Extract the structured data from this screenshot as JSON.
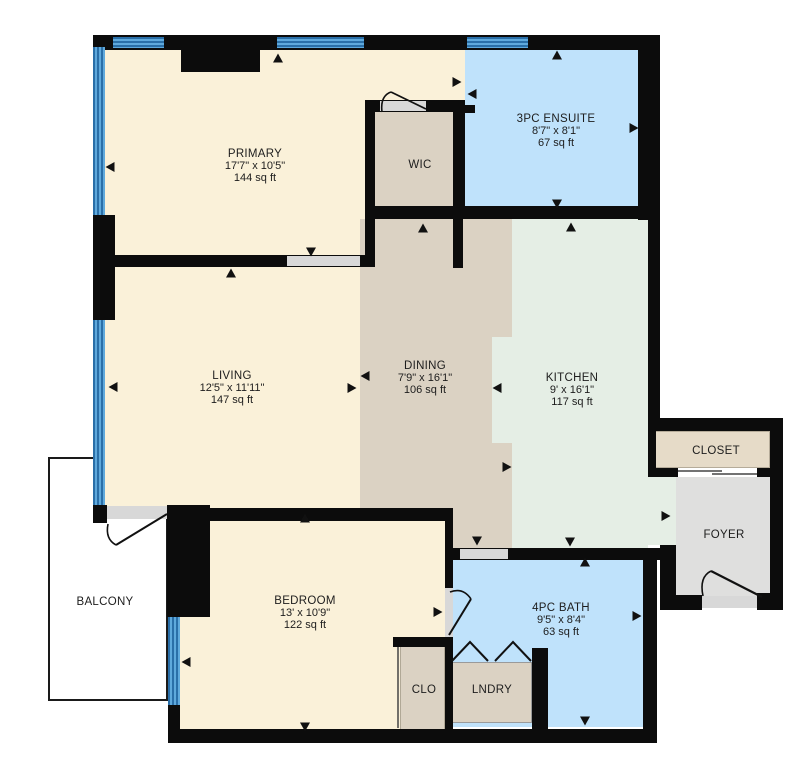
{
  "rooms": {
    "primary": {
      "name": "PRIMARY",
      "dims": "17'7\" x 10'5\"",
      "area": "144 sq ft"
    },
    "wic": {
      "name": "WIC"
    },
    "ensuite": {
      "name": "3PC ENSUITE",
      "dims": "8'7\" x 8'1\"",
      "area": "67 sq ft"
    },
    "living": {
      "name": "LIVING",
      "dims": "12'5\" x 11'11\"",
      "area": "147 sq ft"
    },
    "dining": {
      "name": "DINING",
      "dims": "7'9\" x 16'1\"",
      "area": "106 sq ft"
    },
    "kitchen": {
      "name": "KITCHEN",
      "dims": "9' x 16'1\"",
      "area": "117 sq ft"
    },
    "closet": {
      "name": "CLOSET"
    },
    "foyer": {
      "name": "FOYER"
    },
    "bedroom": {
      "name": "BEDROOM",
      "dims": "13' x 10'9\"",
      "area": "122 sq ft"
    },
    "bath": {
      "name": "4PC BATH",
      "dims": "9'5\" x 8'4\"",
      "area": "63 sq ft"
    },
    "clo": {
      "name": "CLO"
    },
    "lndry": {
      "name": "LNDRY"
    },
    "balcony": {
      "name": "BALCONY"
    }
  },
  "colors": {
    "wall": "#0c0c0c",
    "bedroom_fill": "#faf1d9",
    "dining_fill": "#dbd2c3",
    "bath_fill": "#bfe2fb",
    "kitchen_fill": "#e5eee5",
    "foyer_fill": "#dfdfde",
    "closet_fill": "#e6dbc8",
    "window_light": "#5fa9dc",
    "window_dark": "#2a6fa8",
    "doorway": "#d8d8d8",
    "background": "#ffffff",
    "text": "#1d1d1d"
  }
}
